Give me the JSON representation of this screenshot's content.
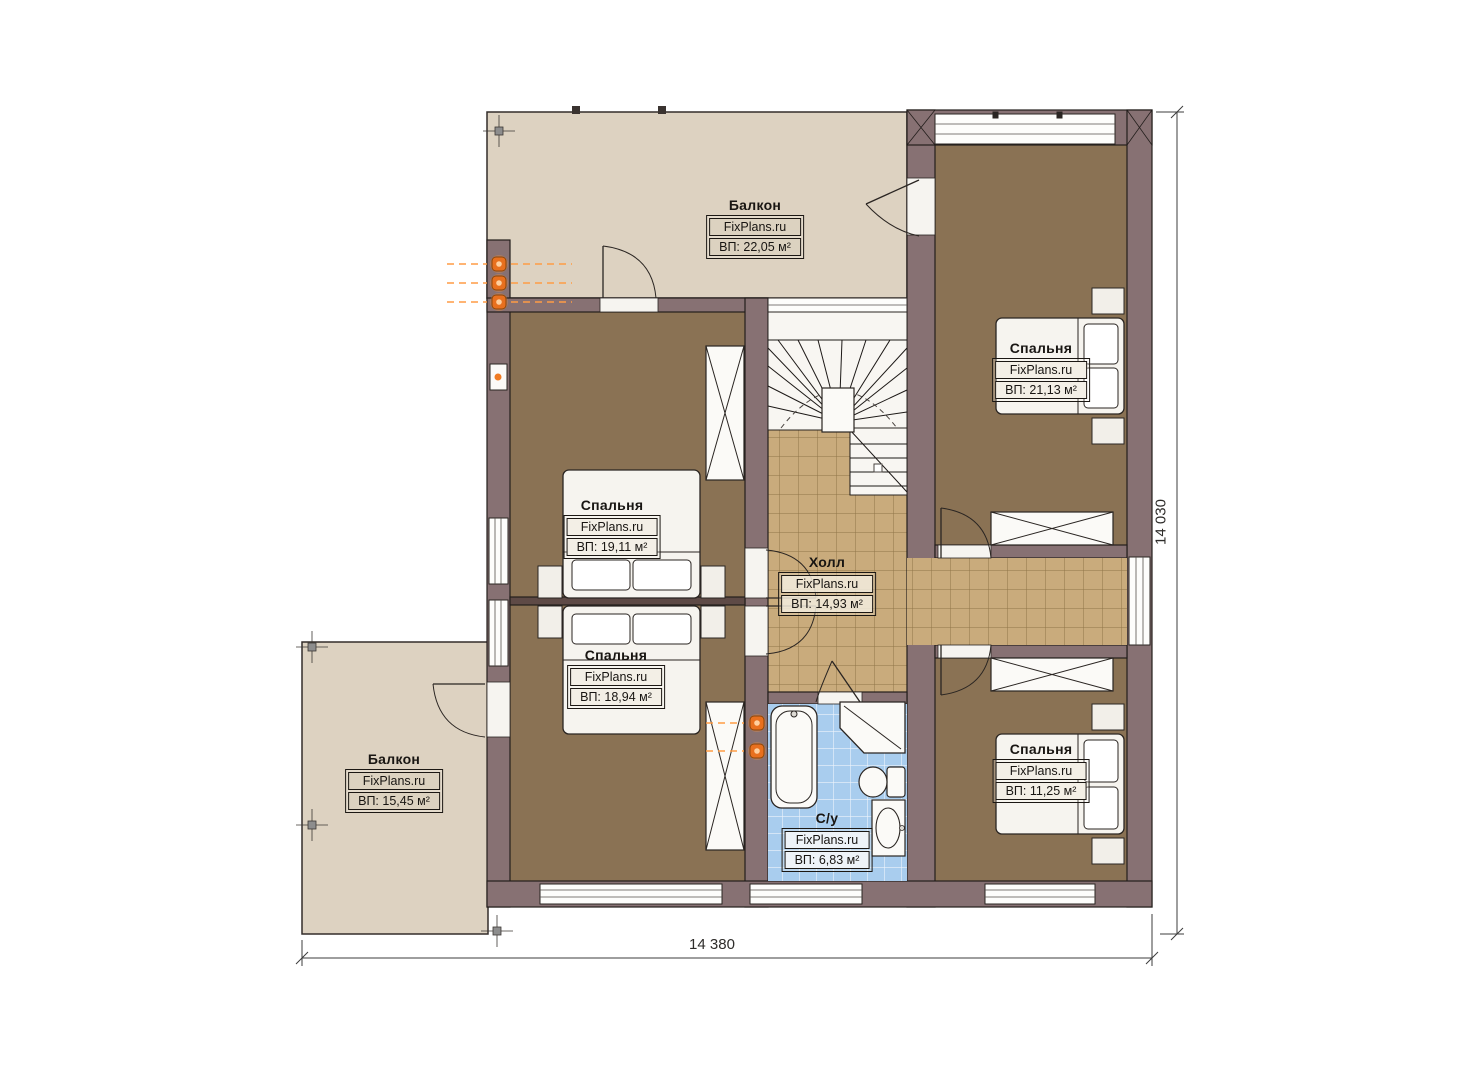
{
  "brand": "FixPlans.ru",
  "rooms": [
    {
      "id": "balcony-top",
      "name": "Балкон",
      "brand": "FixPlans.ru",
      "area": "ВП: 22,05 м²"
    },
    {
      "id": "bedroom-top-right",
      "name": "Спальня",
      "brand": "FixPlans.ru",
      "area": "ВП: 21,13 м²"
    },
    {
      "id": "bedroom-left-upper",
      "name": "Спальня",
      "brand": "FixPlans.ru",
      "area": "ВП: 19,11 м²"
    },
    {
      "id": "bedroom-left-lower",
      "name": "Спальня",
      "brand": "FixPlans.ru",
      "area": "ВП: 18,94 м²"
    },
    {
      "id": "hall",
      "name": "Холл",
      "brand": "FixPlans.ru",
      "area": "ВП: 14,93 м²"
    },
    {
      "id": "balcony-bottom-left",
      "name": "Балкон",
      "brand": "FixPlans.ru",
      "area": "ВП: 15,45 м²"
    },
    {
      "id": "bedroom-bottom-right",
      "name": "Спальня",
      "brand": "FixPlans.ru",
      "area": "ВП: 11,25 м²"
    },
    {
      "id": "bathroom",
      "name": "С/у",
      "brand": "FixPlans.ru",
      "area": "ВП: 6,83 м²"
    }
  ],
  "dimensions": {
    "width_label": "14 380",
    "height_label": "14 030"
  },
  "colors": {
    "wall": "#877173",
    "bedroom_floor": "#8a7254",
    "hall_tile": "#c9ab7c",
    "bathroom_tile": "#a9cdee",
    "balcony_floor": "#ddd2c1",
    "radiator": "#e8701f"
  }
}
